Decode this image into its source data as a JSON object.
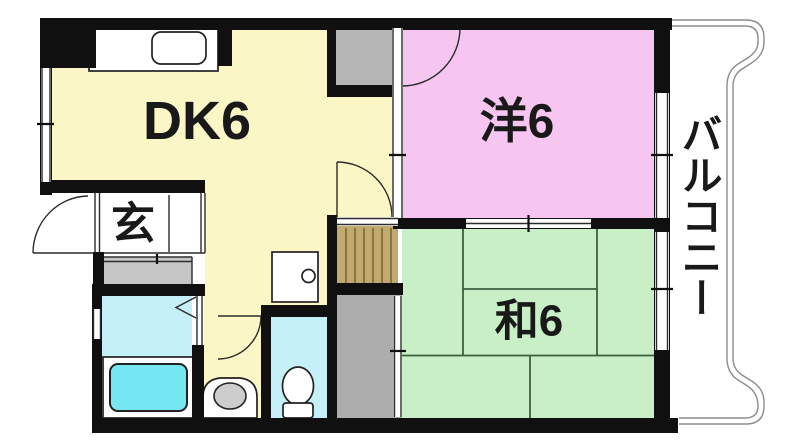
{
  "floorplan": {
    "rooms": {
      "dk": {
        "label": "DK6",
        "color": "#FAF6C5"
      },
      "western": {
        "label": "洋6",
        "color": "#F6C5F0"
      },
      "japanese": {
        "label": "和6",
        "color": "#C8EFC6"
      },
      "genkan": {
        "label": "玄",
        "color": "#FFFFFF"
      },
      "balcony": {
        "label": "バルコニー",
        "color": "#FFFFFF"
      }
    },
    "colors": {
      "wall": "#101010",
      "water_room": "#C6F0F7",
      "bathtub": "#74E7F2",
      "closet_gray": "#B5B5B5",
      "closet_lower_gray": "#ADADAD",
      "closet_tan": "#C2A96D",
      "closet_tan_stripe": "#8A7444",
      "shoe_cabinet": "#C6C6C6",
      "basin": "#CDCDCD",
      "tatami_line": "#3E5E3E",
      "balcony_line": "#8C8C8C",
      "label_text": "#191919"
    }
  }
}
